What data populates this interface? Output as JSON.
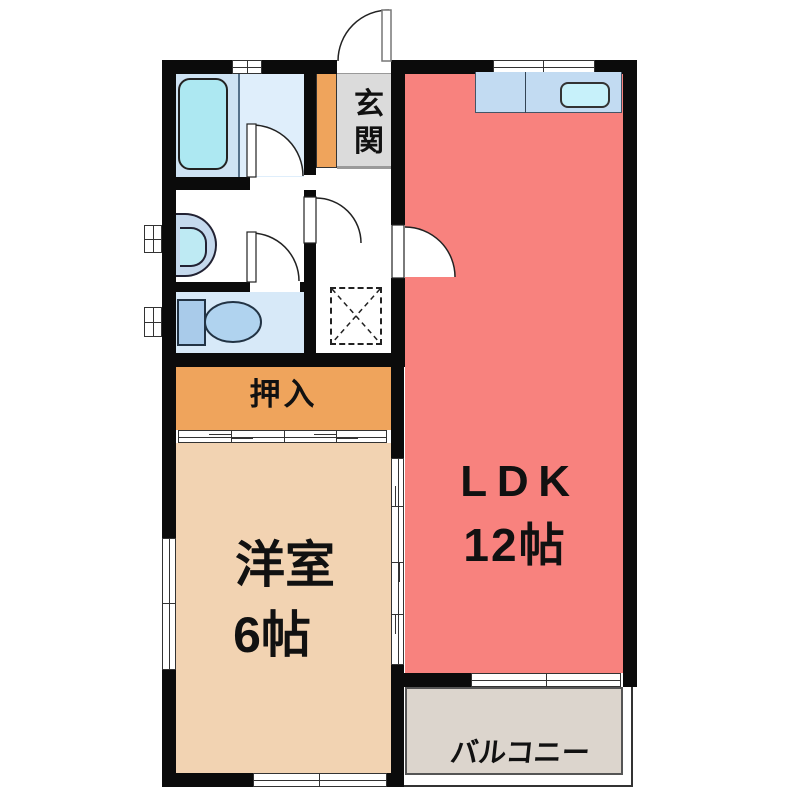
{
  "plan": {
    "type": "apartment-floorplan-1LDK",
    "rooms": {
      "genkan": {
        "label": "玄関"
      },
      "ldk": {
        "name": "LDK",
        "size": "12帖"
      },
      "western": {
        "name": "洋室",
        "size": "6帖"
      },
      "oshiire": {
        "label": "押入"
      },
      "balcony": {
        "label": "バルコニー"
      }
    },
    "fixtures": [
      "bathtub",
      "vanity-sink",
      "toilet",
      "kitchen-counter",
      "kitchen-sink",
      "washing-machine-space",
      "entrance-door",
      "hinged-door",
      "sliding-door",
      "window"
    ],
    "colors": {
      "wall": "#0b0b0b",
      "ldk": "#F8827E",
      "western_room": "#F2D3B2",
      "oshiire": "#EFA45C",
      "genkan_floor": "#DBDBDB",
      "genkan_cabinet": "#EFA45C",
      "balcony": "#DCD5CD",
      "bath_left": "#CEE3F3",
      "bath_right": "#DFEEFB",
      "toilet_room": "#D7E9F8",
      "counter": "#C2DBF2",
      "sink": "#C7F1FA",
      "bathtub": "#ADE8F2",
      "text": "#111111"
    }
  }
}
